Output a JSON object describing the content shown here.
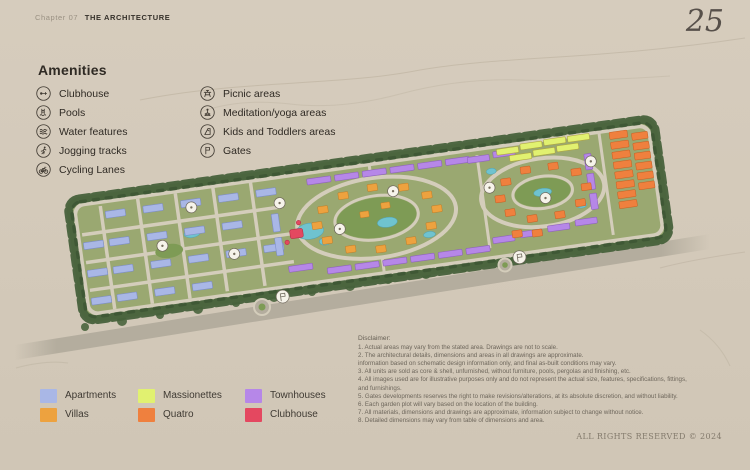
{
  "page": {
    "background": "#d3c9b9"
  },
  "header": {
    "chapter": "Chapter 07",
    "title": "THE ARCHITECTURE",
    "page_number": "25"
  },
  "amenities": {
    "title": "Amenities",
    "left": [
      {
        "icon": "clubhouse-icon",
        "label": "Clubhouse"
      },
      {
        "icon": "pools-icon",
        "label": "Pools"
      },
      {
        "icon": "water-features-icon",
        "label": "Water features"
      },
      {
        "icon": "jogging-tracks-icon",
        "label": "Jogging tracks"
      },
      {
        "icon": "cycling-lanes-icon",
        "label": "Cycling Lanes"
      }
    ],
    "right": [
      {
        "icon": "picnic-areas-icon",
        "label": "Picnic areas"
      },
      {
        "icon": "meditation-yoga-icon",
        "label": "Meditation/yoga areas"
      },
      {
        "icon": "kids-toddlers-icon",
        "label": "Kids and Toddlers areas"
      },
      {
        "icon": "gates-icon",
        "label": "Gates"
      }
    ]
  },
  "legend": {
    "items": [
      {
        "key": "apartments",
        "label": "Apartments",
        "color": "#a9b7e6"
      },
      {
        "key": "massionettes",
        "label": "Massionettes",
        "color": "#e1f170"
      },
      {
        "key": "townhouses",
        "label": "Townhouses",
        "color": "#b687e8"
      },
      {
        "key": "villas",
        "label": "Villas",
        "color": "#eda23f"
      },
      {
        "key": "quatro",
        "label": "Quatro",
        "color": "#ef803e"
      },
      {
        "key": "clubhouse",
        "label": "Clubhouse",
        "color": "#e44860"
      }
    ]
  },
  "disclaimer": {
    "title": "Disclaimer:",
    "text": "1. Actual areas may vary from the stated area. Drawings are not to scale.\n2. The architectural details, dimensions and areas in all drawings are approximate.\ninformation based on schematic design information only, and final as-built conditions may vary.\n3. All units are sold as core & shell, unfurnished, without furniture, pools, pergolas and finishing, etc.\n4. All images used are for illustrative purposes only and do not represent the actual size, features, specifications, fittings,\nand furnishings.\n5. Gates developments reserves the right to make revisions/alterations, at its absolute discretion, and without liability.\n6. Each garden plot will vary based on the location of the building.\n7. All materials, dimensions and drawings are approximate, information subject to change without notice.\n8. Detailed dimensions may vary from table of dimensions and area."
  },
  "footer": {
    "rights": "ALL RIGHTS RESERVED © 2024"
  }
}
